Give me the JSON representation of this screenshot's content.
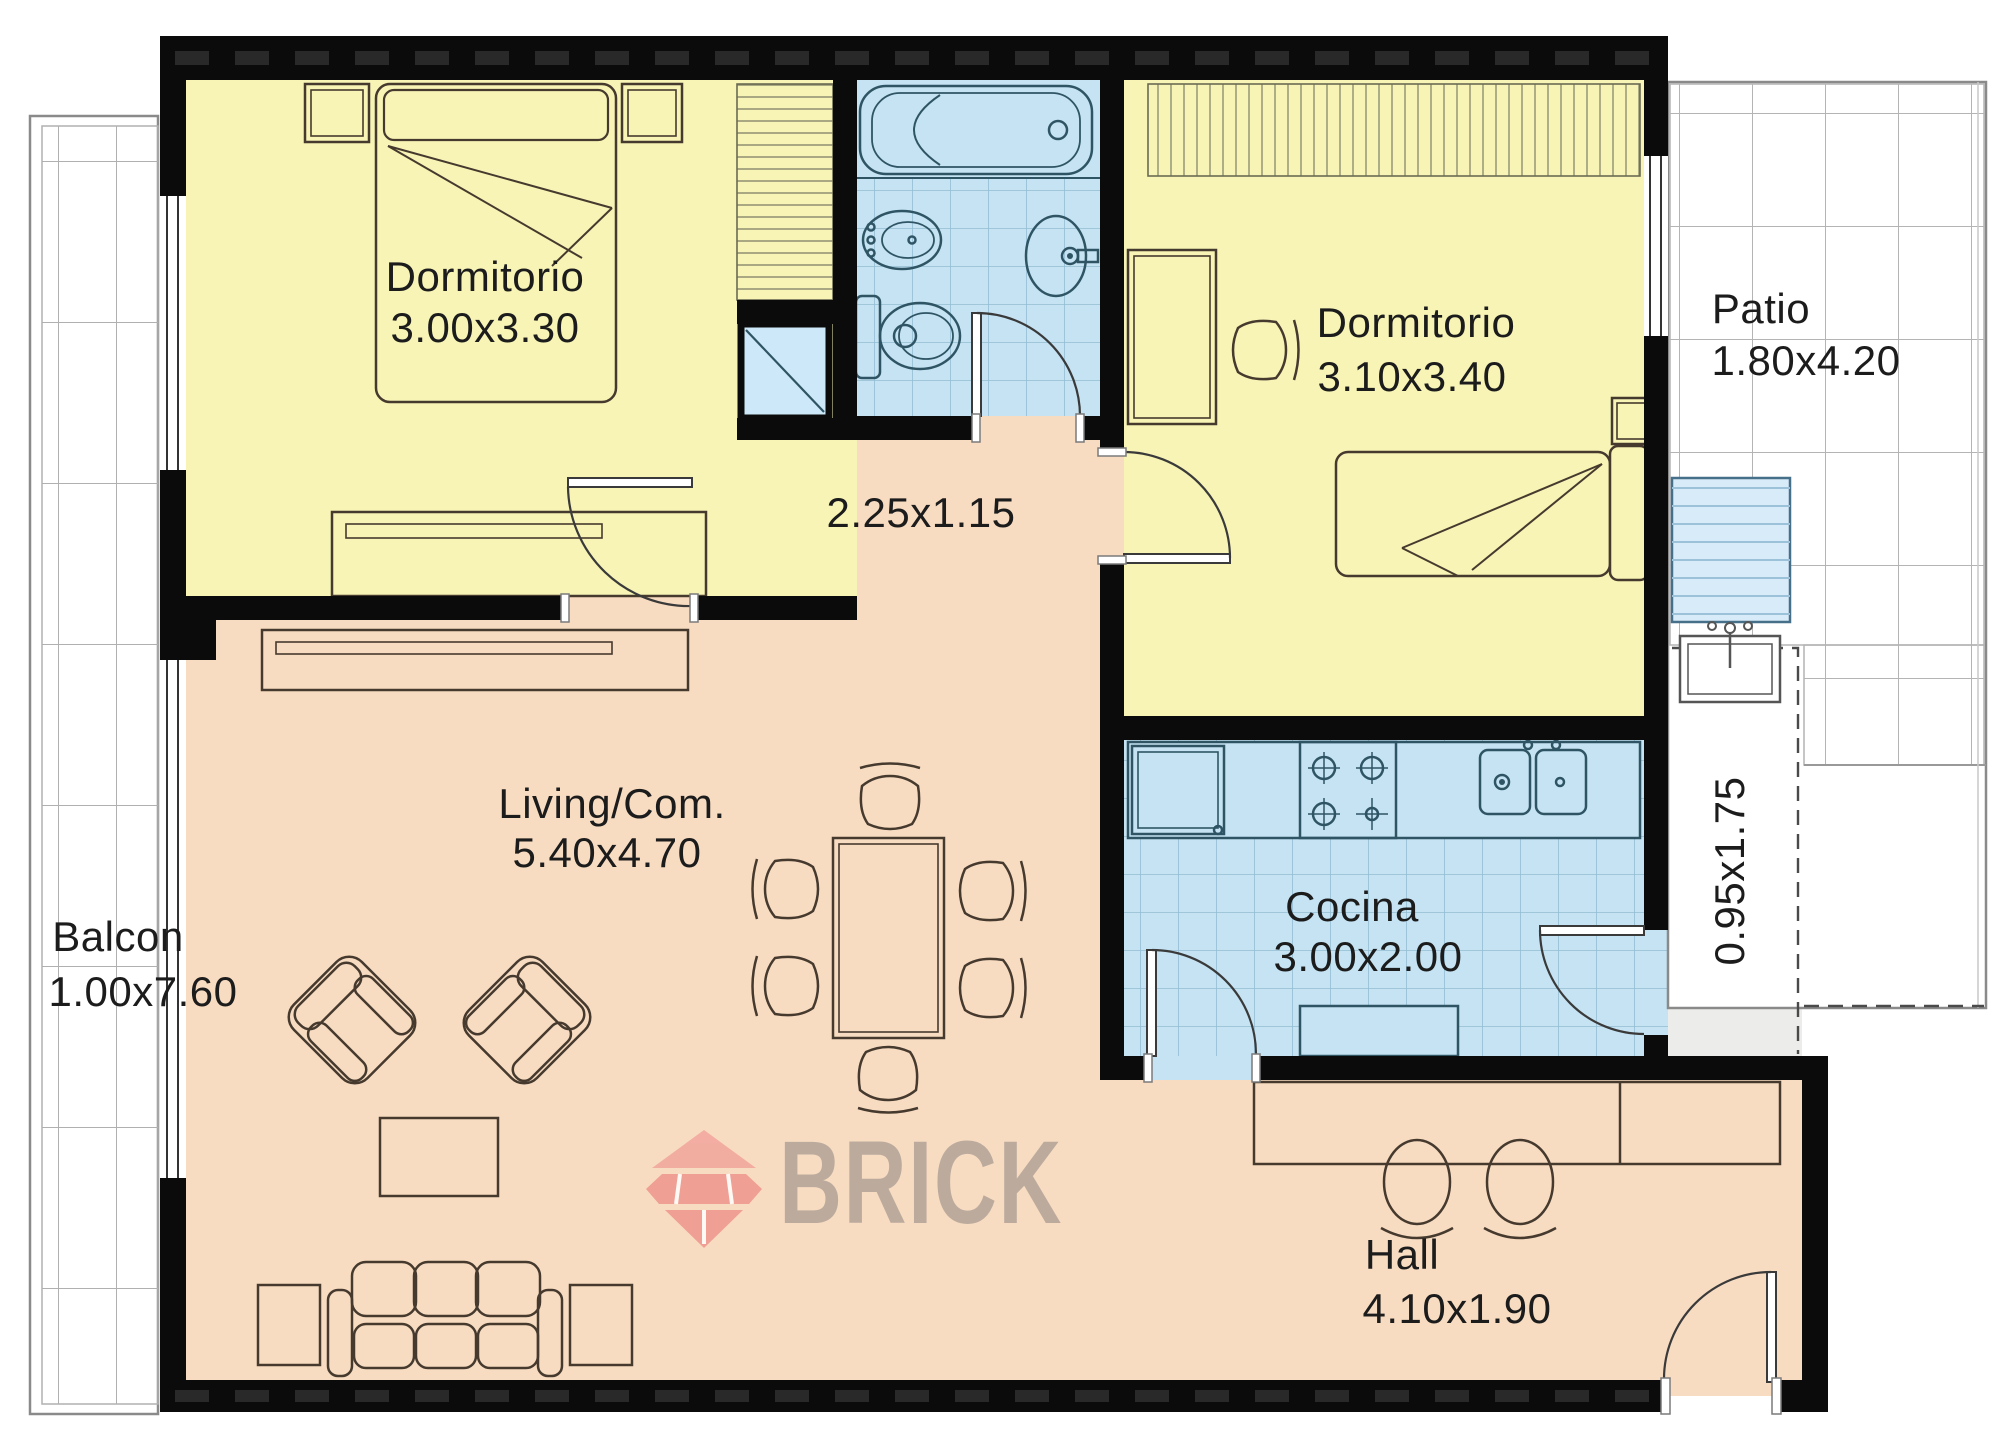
{
  "rooms": {
    "dormitorio1": {
      "label": "Dormitorio",
      "dims": "3.00x3.30"
    },
    "dormitorio2": {
      "label": "Dormitorio",
      "dims": "3.10x3.40"
    },
    "living": {
      "label": "Living/Com.",
      "dims": "5.40x4.70"
    },
    "cocina": {
      "label": "Cocina",
      "dims": "3.00x2.00"
    },
    "hall": {
      "label": "Hall",
      "dims": "4.10x1.90"
    },
    "balcon": {
      "label": "Balcon",
      "dims": "1.00x7.60"
    },
    "patio": {
      "label": "Patio",
      "dims": "1.80x4.20"
    },
    "pasillo": {
      "dims": "2.25x1.15"
    },
    "lavadero": {
      "dims": "0.95x1.75"
    }
  },
  "watermark": {
    "brand": "BRICK"
  },
  "colors": {
    "bedroom_yellow": "#f7f4b6",
    "living_peach": "#f8dcc2",
    "wet_room_blue": "#c5e3f3",
    "wall_black": "#0b0b0b",
    "laundry_gray": "#ececea",
    "logo_red": "#ee958c",
    "logo_text_gray": "#bcab9d"
  }
}
